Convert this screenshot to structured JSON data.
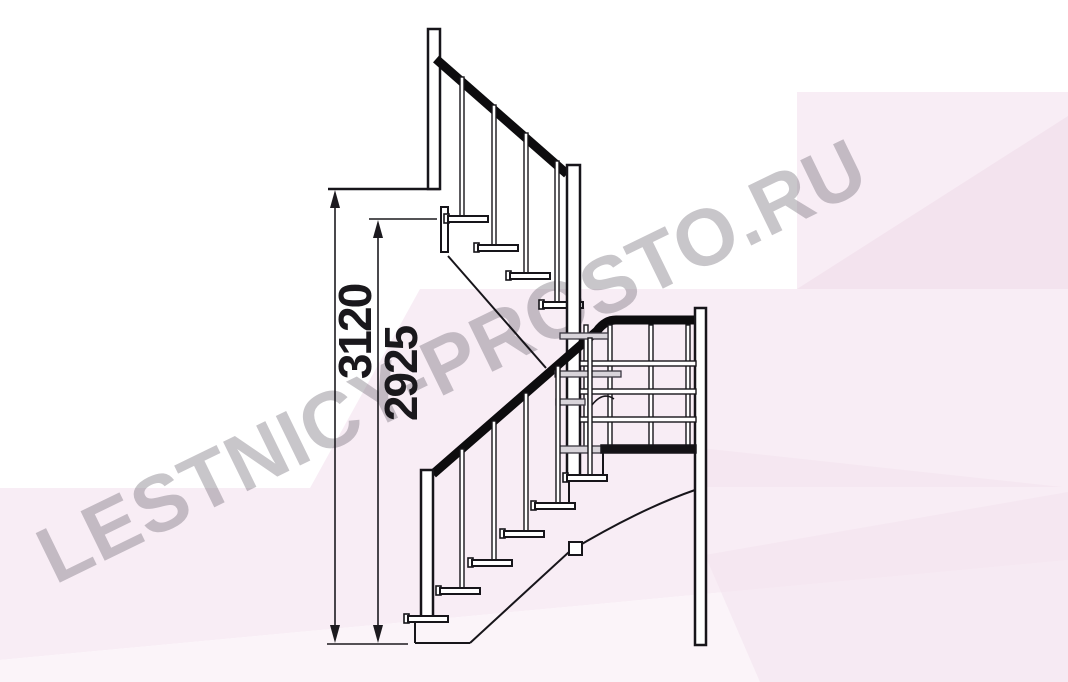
{
  "watermark": {
    "text": "LESTNICY-PROSTO.RU",
    "color": "#57505c",
    "opacity": 0.32
  },
  "dimensions": {
    "total_height": {
      "label": "3120"
    },
    "partial_height": {
      "label": "2925"
    }
  },
  "colors": {
    "ink": "#17151a",
    "handrail": "#0d0c0e",
    "pink_base": "#f8edf5",
    "pink_dark": "#f3e3ee",
    "pink_light": "#fbf4f9",
    "tread_gray": "#d8d4da",
    "white": "#ffffff"
  }
}
